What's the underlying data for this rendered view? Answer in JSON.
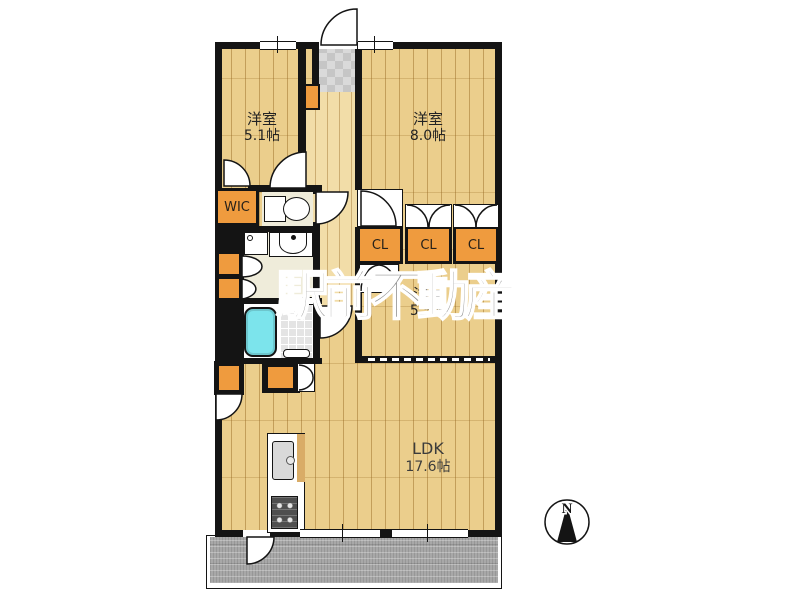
{
  "watermark": "駅前不動産",
  "compass": {
    "label": "N"
  },
  "rooms": {
    "room51": {
      "name": "洋室",
      "size": "5.1帖"
    },
    "room80": {
      "name": "洋室",
      "size": "8.0帖"
    },
    "room55": {
      "name": "洋室",
      "size": "5.5帖"
    },
    "ldk": {
      "name": "LDK",
      "size": "17.6帖"
    }
  },
  "storage": {
    "wic": "WIC",
    "cl1": "CL",
    "cl2": "CL",
    "cl3": "CL"
  },
  "colors": {
    "wall": "#141414",
    "wood_floor": "#ebce8c",
    "hall_floor": "#f2dda8",
    "closet_orange": "#ef9b3e",
    "service_floor": "#efecda",
    "bathtub_cyan": "#7ce4ec",
    "balcony_gray": "#a8a8a8",
    "watermark_gray": "#8f8f8f"
  }
}
